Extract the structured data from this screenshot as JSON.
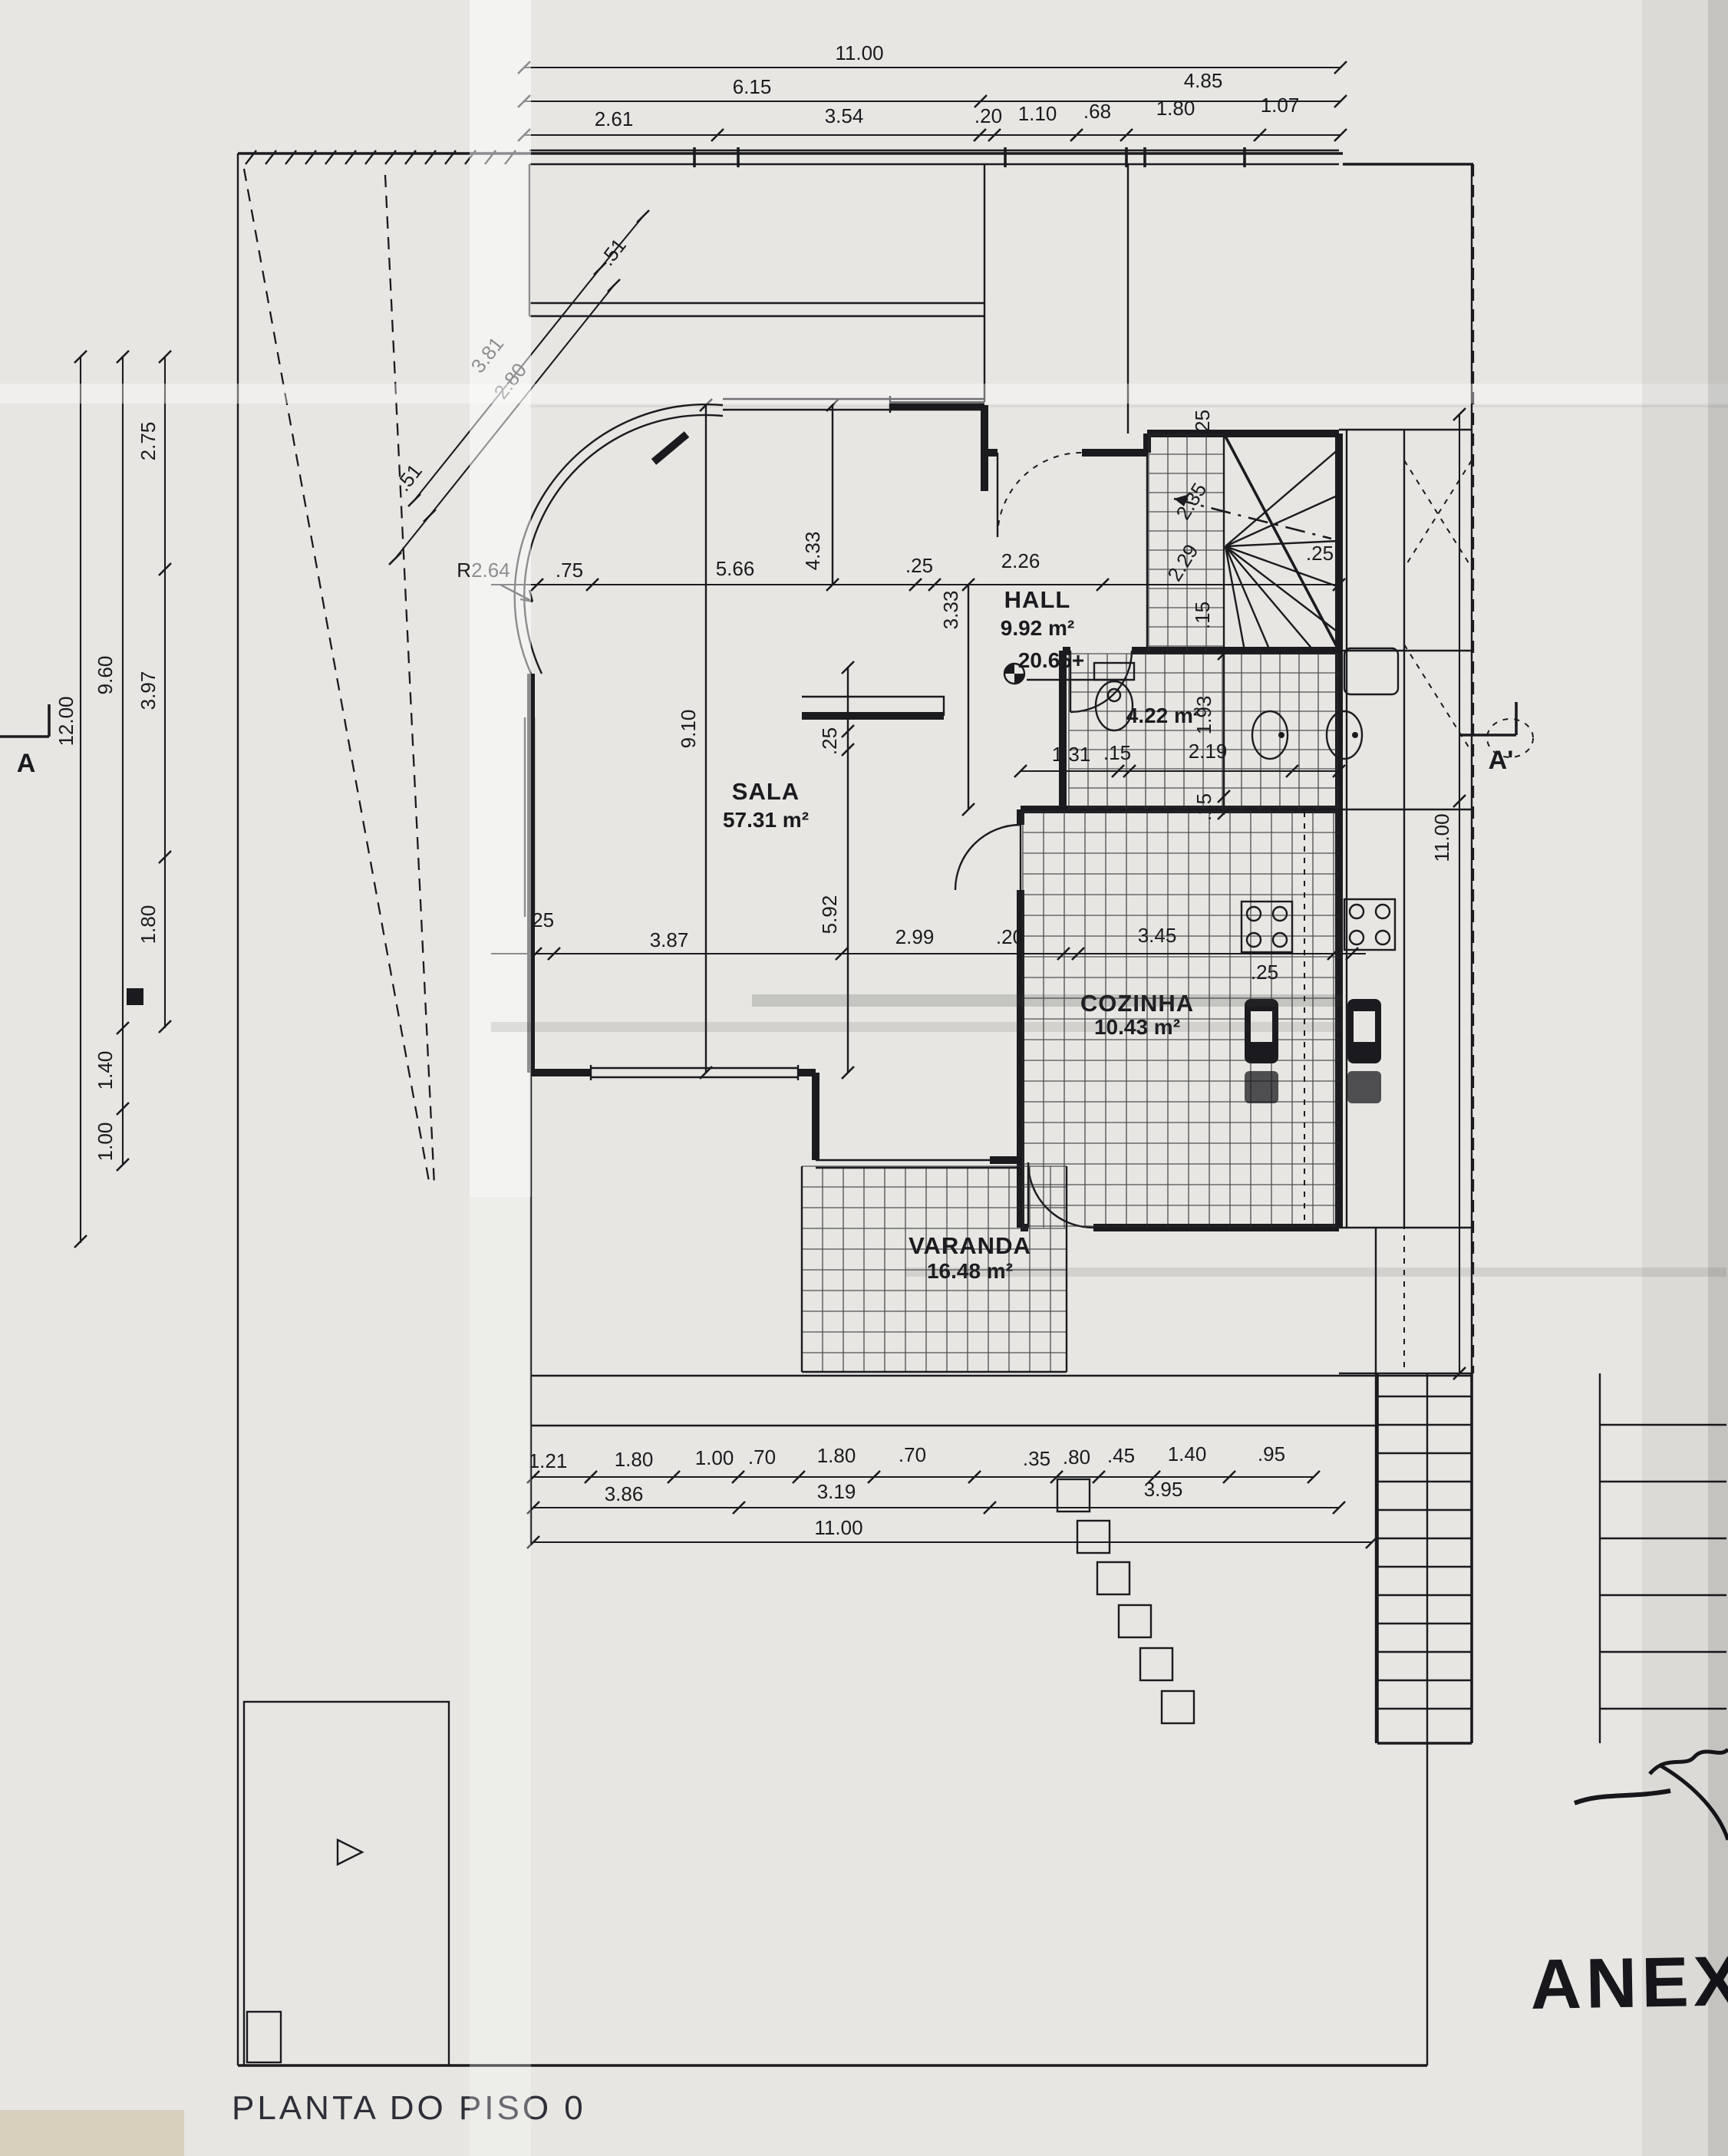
{
  "page": {
    "title": "PLANTA DO PISO 0",
    "handwritten_note": "ANEXO"
  },
  "markers": {
    "section_left": "A",
    "section_right": "A'",
    "level": "20.65+",
    "radius": "R2.64"
  },
  "rooms": {
    "hall": {
      "name": "HALL",
      "area": "9.92 m²"
    },
    "sala": {
      "name": "SALA",
      "area": "57.31 m²"
    },
    "cozinha": {
      "name": "COZINHA",
      "area": "10.43 m²"
    },
    "varanda": {
      "name": "VARANDA",
      "area": "16.48 m²"
    },
    "wc": {
      "area": "4.22 m²"
    }
  },
  "dims": {
    "top1": "11.00",
    "top2a": "6.15",
    "top2b": "4.85",
    "top3": [
      "2.61",
      "3.54",
      ".20",
      "1.10",
      ".68",
      "1.80",
      "1.07"
    ],
    "left_outer": "12.00",
    "left_mid": [
      "9.60",
      "1.40",
      "1.00"
    ],
    "left_inner": [
      "2.75",
      "3.97",
      "1.80"
    ],
    "diag": [
      "3.81",
      "2.80",
      ".51",
      ".51"
    ],
    "right": "11.00",
    "interior_top": [
      ".75",
      "5.66",
      "4.33",
      ".25",
      "2.26",
      "3.33"
    ],
    "stair": [
      ".25",
      "2.35",
      "2.29",
      ".25",
      ".15"
    ],
    "wc": [
      "1.93",
      "1.31",
      ".15",
      "2.19",
      ".15"
    ],
    "sala_v": [
      "9.10",
      ".25",
      "5.92"
    ],
    "mid": [
      ".25",
      "3.87",
      "2.99",
      ".20",
      "3.45",
      ".25"
    ],
    "bottom1": [
      "1.21",
      "1.80",
      "1.00",
      ".70",
      "1.80",
      ".70",
      ".35",
      ".80",
      ".45",
      "1.40",
      ".95"
    ],
    "bottom2": [
      "3.86",
      "3.19",
      "3.95"
    ],
    "bottom3": "11.00"
  },
  "colors": {
    "paper": "#e7e6e2",
    "ink": "#1b1b1f",
    "title_ink": "#2e2e38"
  }
}
